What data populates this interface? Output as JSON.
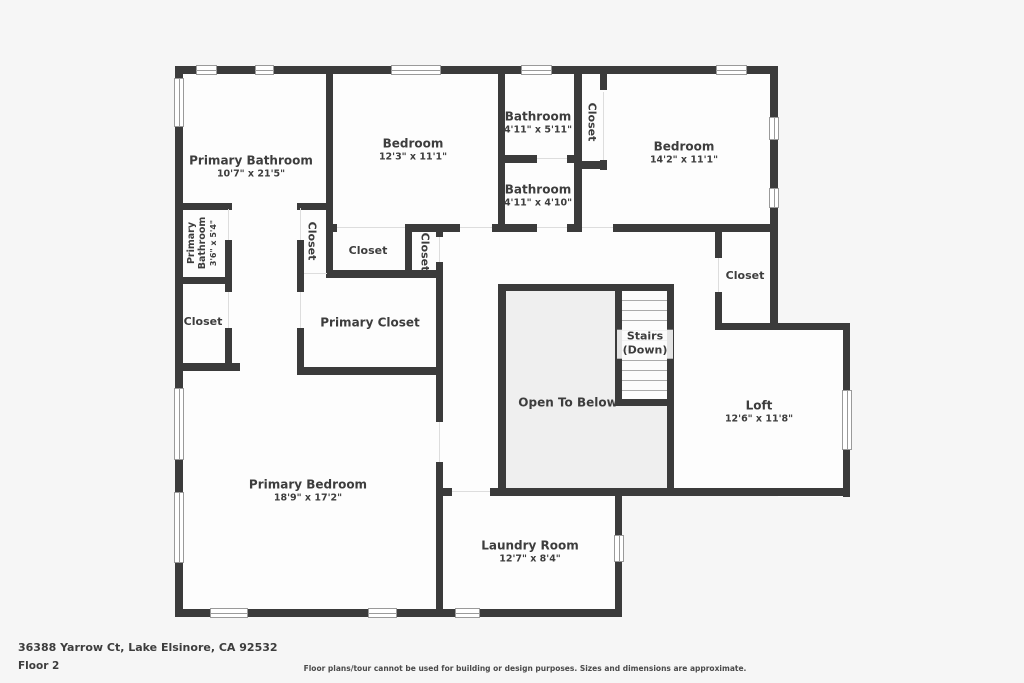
{
  "colors": {
    "wall": "#3b3b3b",
    "room_fill": "#fdfdfd",
    "open_area_fill": "#efefef",
    "background": "#f6f6f6",
    "label_text": "#3d3d3d"
  },
  "rooms": {
    "primary_bathroom": {
      "name": "Primary Bathroom",
      "dims": "10'7\" x 21'5\""
    },
    "bedroom_top_left": {
      "name": "Bedroom",
      "dims": "12'3\" x 11'1\""
    },
    "bathroom_upper": {
      "name": "Bathroom",
      "dims": "4'11\" x 5'11\""
    },
    "hall_closet": {
      "name": "Closet"
    },
    "bedroom_top_right": {
      "name": "Bedroom",
      "dims": "14'2\" x 11'1\""
    },
    "bathroom_lower": {
      "name": "Bathroom",
      "dims": "4'11\" x 4'10\""
    },
    "primary_bathroom_wc": {
      "name": "Primary Bathroom",
      "dims": "3'6\" x 5'4\""
    },
    "closet_a": {
      "name": "Closet"
    },
    "closet_b": {
      "name": "Closet"
    },
    "closet_c": {
      "name": "Closet"
    },
    "closet_left": {
      "name": "Closet"
    },
    "primary_closet": {
      "name": "Primary Closet"
    },
    "closet_right": {
      "name": "Closet"
    },
    "stairs": {
      "name": "Stairs (Down)"
    },
    "open_to_below": {
      "name": "Open To Below"
    },
    "loft": {
      "name": "Loft",
      "dims": "12'6\" x 11'8\""
    },
    "primary_bedroom": {
      "name": "Primary Bedroom",
      "dims": "18'9\" x 17'2\""
    },
    "laundry_room": {
      "name": "Laundry Room",
      "dims": "12'7\" x 8'4\""
    }
  },
  "footer": {
    "address": "36388 Yarrow Ct, Lake Elsinore, CA 92532",
    "floor_label": "Floor 2",
    "disclaimer": "Floor plans/tour cannot be used for building or design purposes. Sizes and dimensions are approximate."
  }
}
